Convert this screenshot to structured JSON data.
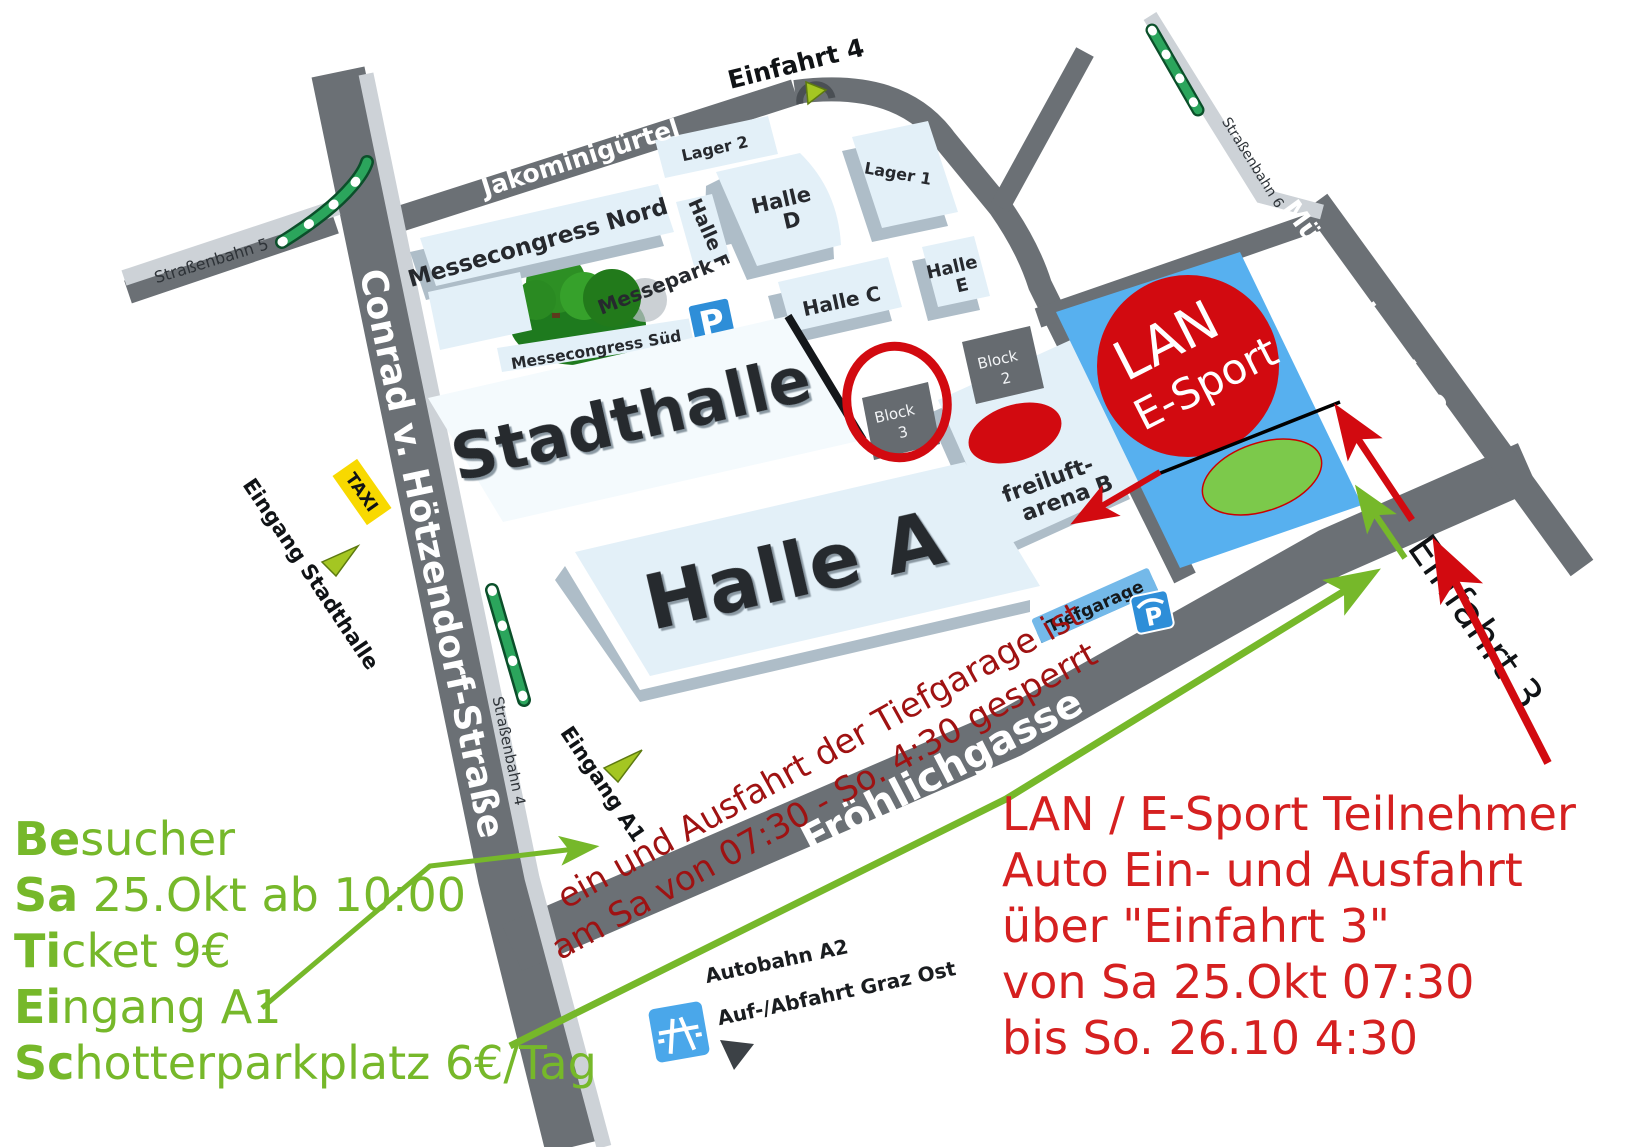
{
  "colors": {
    "road": "#6b7075",
    "band": "#cdd2d7",
    "roof": "#e3f0f8",
    "skirt": "#aebdc8",
    "blockgray": "#666b70",
    "parkblue": "#57b0ef",
    "red": "#d20a10",
    "redtext": "#d52020",
    "darkred": "#9f1212",
    "green": "#76b82a",
    "markergreen": "#a4c622",
    "ellipsegreen": "#7cc94b",
    "tramgreen": "#2ba55c",
    "taxiyellow": "#f8d900",
    "iconblue": "#2e8ed8",
    "autobahnblue": "#4aa7ea",
    "treegreen": "#1e7a1e"
  },
  "roads": {
    "jakominiguertel": "Jakominigürtel",
    "conrad": "Conrad v. Hötzendorf-Straße",
    "muenzgrabenstrasse": "Münzgrabenstraße",
    "froehlichgasse": "Fröhlichgasse"
  },
  "trams": {
    "line5": "Straßenbahn 5",
    "line4": "Straßenbahn 4",
    "line6": "Straßenbahn 6"
  },
  "entrances": {
    "einfahrt4": "Einfahrt 4",
    "einfahrt3": "Einfahrt 3",
    "eingang_stadthalle": "Eingang Stadthalle",
    "eingang_a1": "Eingang A1",
    "taxi": "TAXI"
  },
  "buildings": {
    "messecongress_nord": "Messecongress Nord",
    "messecongress_sued": "Messecongress Süd",
    "messepark": "Messepark",
    "halle_f": "Halle F",
    "halle_d": {
      "line1": "Halle",
      "line2": "D"
    },
    "halle_c": "Halle C",
    "halle_e": {
      "line1": "Halle",
      "line2": "E"
    },
    "lager1": "Lager 1",
    "lager2": "Lager 2",
    "stadthalle": "Stadthalle",
    "halle_a": "Halle A",
    "block3": {
      "line1": "Block",
      "line2": "3"
    },
    "block2": {
      "line1": "Block",
      "line2": "2"
    },
    "freiluft_arena": {
      "line1": "freiluft-",
      "line2": "arena B"
    },
    "tiefgarage": "Tiefgarage"
  },
  "event": {
    "line1": "LAN",
    "line2": "E-Sport"
  },
  "parking_icon": {
    "letter": "P"
  },
  "autobahn": {
    "line1": "Autobahn A2",
    "line2": "Auf-/Abfahrt Graz Ost"
  },
  "note_red": {
    "line1": "ein und Ausfahrt der Tiefgarage ist",
    "line2": "am Sa von 07:30 - So. 4:30 gesperrt"
  },
  "legend_green": {
    "line1": {
      "bold": "Be",
      "rest": "sucher"
    },
    "line2": {
      "bold": "Sa",
      "rest": " 25.Okt ab 10:00"
    },
    "line3": {
      "bold": "Ti",
      "rest": "cket 9€"
    },
    "line4": {
      "bold": "Ei",
      "rest": "ngang A1"
    },
    "line5": {
      "bold": "Sc",
      "rest": "hotterparkplatz 6€/Tag"
    }
  },
  "legend_red": {
    "line1": "LAN / E-Sport Teilnehmer",
    "line2": "Auto Ein- und Ausfahrt",
    "line3": "über \"Einfahrt 3\"",
    "line4": "von Sa 25.Okt 07:30",
    "line5": "bis So. 26.10 4:30"
  }
}
